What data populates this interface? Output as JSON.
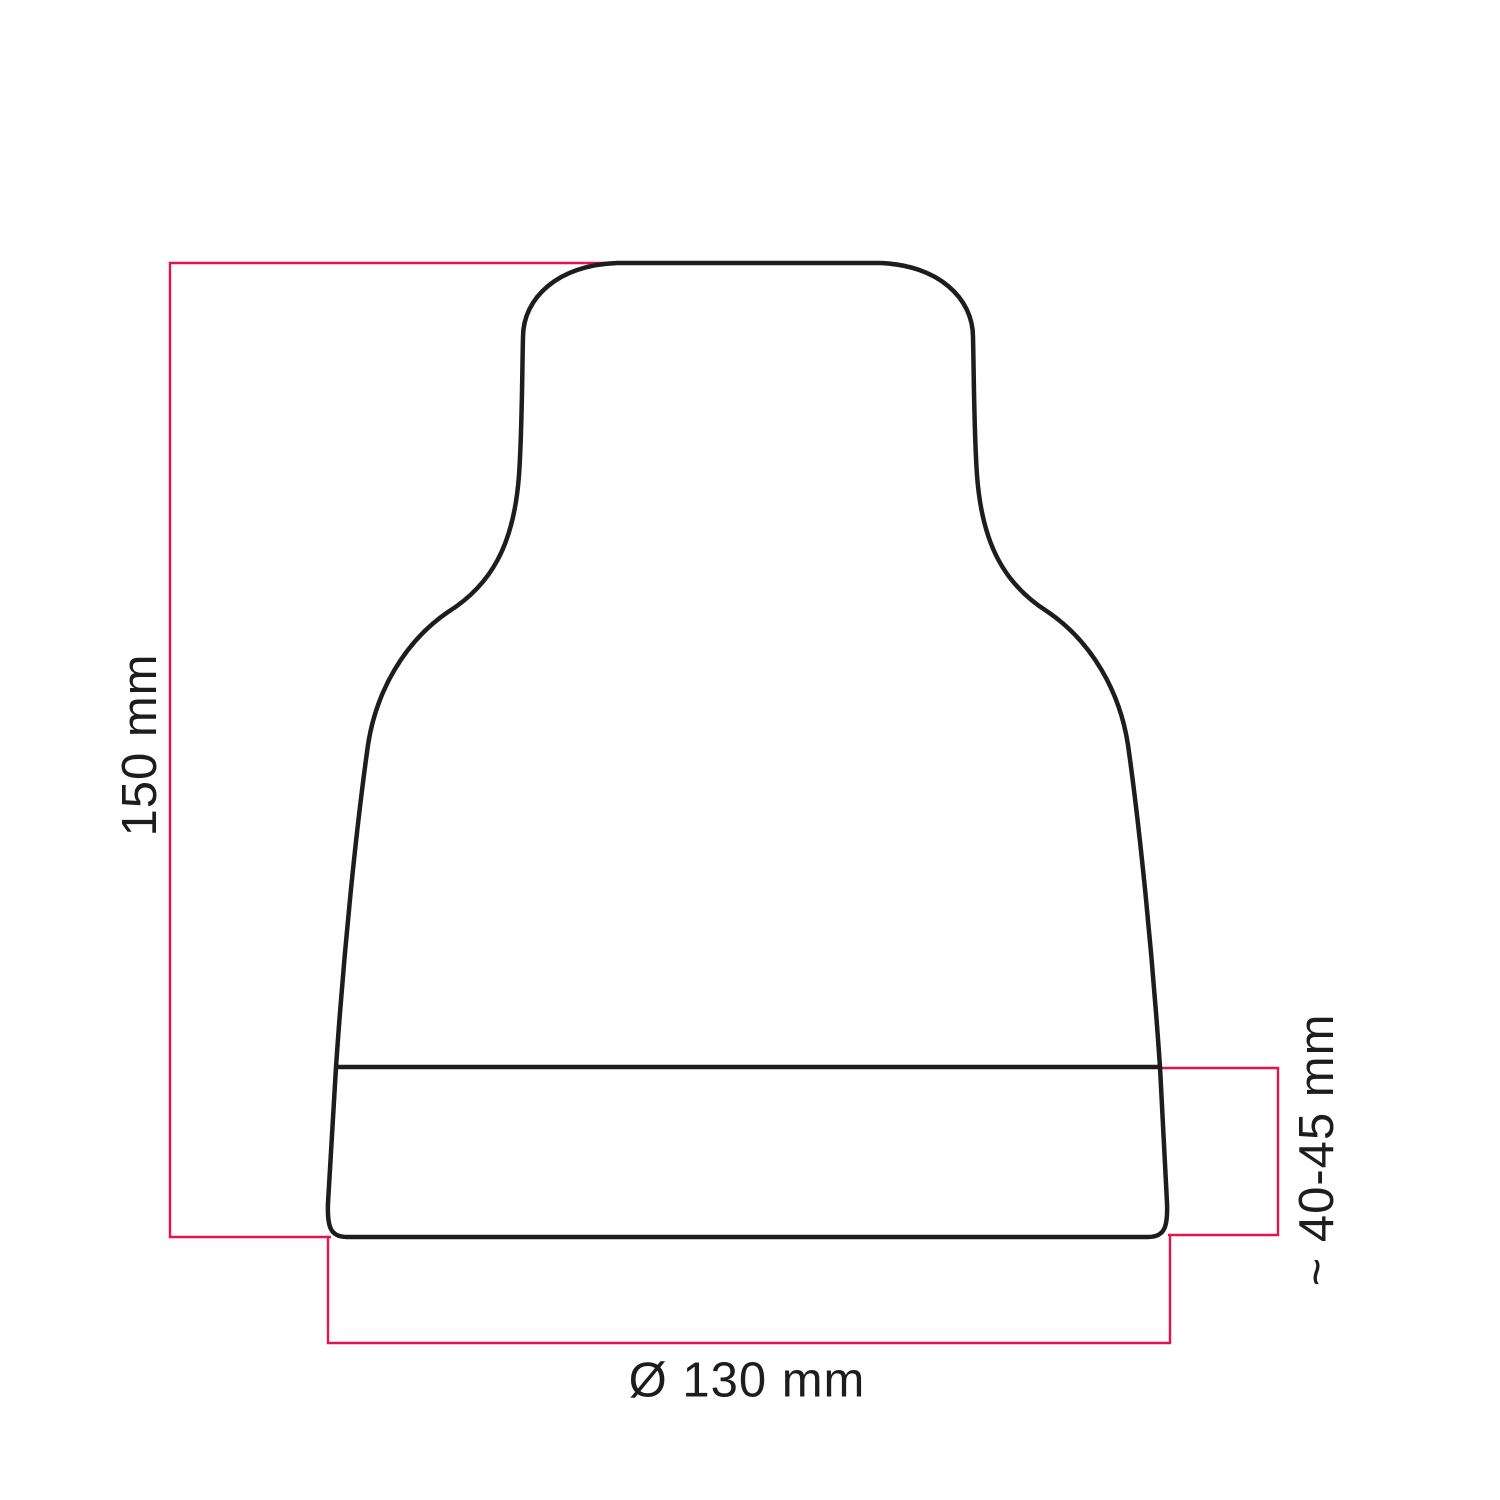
{
  "colors": {
    "background": "#ffffff",
    "outline": "#1d1d1b",
    "dimension_line": "#e11450",
    "label_text": "#1d1d1b"
  },
  "diagram": {
    "kind": "technical-dimension-drawing",
    "labels": {
      "height": "150 mm",
      "diameter": "Ø 130 mm",
      "base_height": "~ 40-45 mm"
    }
  }
}
